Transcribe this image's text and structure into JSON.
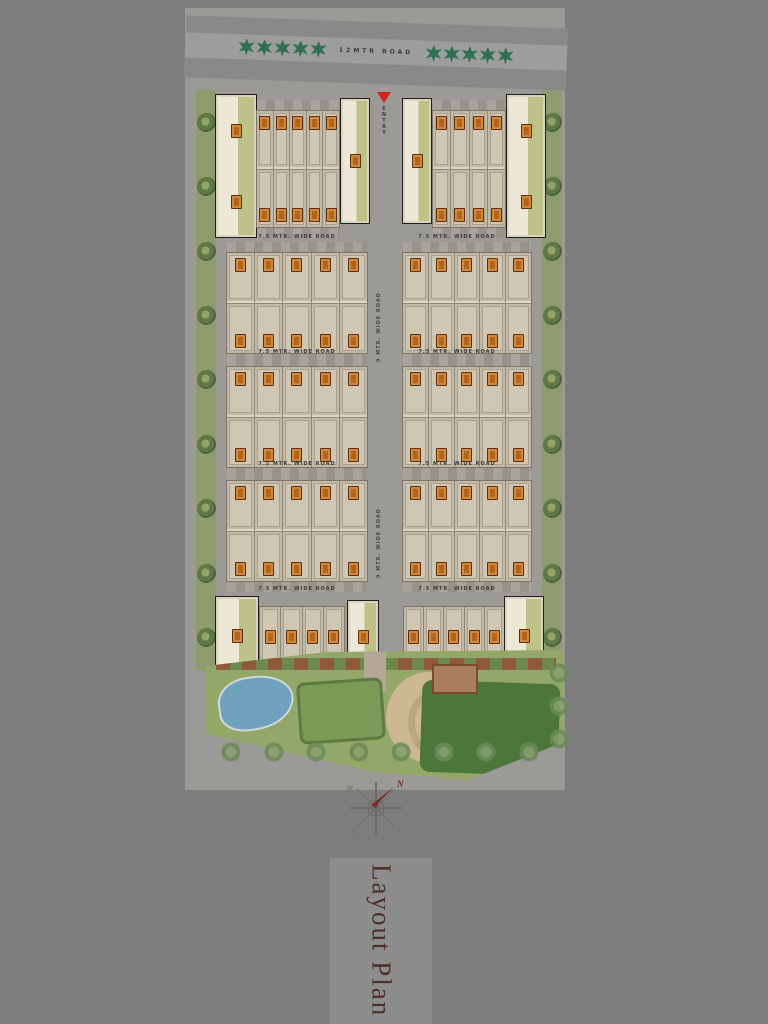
{
  "page": {
    "background": "#7d7d7d"
  },
  "plan": {
    "title": "Layout Plan",
    "main_road_label": "12MTR ROAD",
    "entry_label": "ENTRY",
    "cross_road_label": "7.5 MTR. WIDE ROAD",
    "central_road_label": "9 MTR. WIDE ROAD",
    "rows": [
      {
        "name": "row-1",
        "left_units": 5,
        "right_units": 4,
        "unit_rows": 2
      },
      {
        "name": "row-2",
        "left_units": 5,
        "right_units": 5,
        "unit_rows": 2
      },
      {
        "name": "row-3",
        "left_units": 5,
        "right_units": 5,
        "unit_rows": 2
      },
      {
        "name": "row-4",
        "left_units": 5,
        "right_units": 5,
        "unit_rows": 2
      },
      {
        "name": "row-5",
        "left_units": 4,
        "right_units": 5,
        "unit_rows": 1
      }
    ],
    "perimeter_trees": {
      "left": 9,
      "right": 9,
      "road_left": 5,
      "road_right": 5,
      "amenity": 8,
      "amenity_right": 3
    }
  },
  "compass": {
    "north": "N",
    "south": "S",
    "east": "E",
    "west": "W"
  },
  "colors": {
    "plan_gray": "#9c9a96",
    "road_gray": "#898989",
    "building_beige": "#cfc6b4",
    "unit_badge_orange": "#b2641c",
    "corner_plot_cream": "#ece7d6",
    "yard_green": "#bcc288",
    "verge_green": "#8e9c6d",
    "amenity_green": "#93a768",
    "lawn_dark_green": "#4c763a",
    "pool_blue": "#6fa3bd",
    "sand_tan": "#ccb892",
    "entry_red": "#cc2418",
    "title_maroon": "#4f2f28",
    "road_tree_green": "#2f7050"
  }
}
